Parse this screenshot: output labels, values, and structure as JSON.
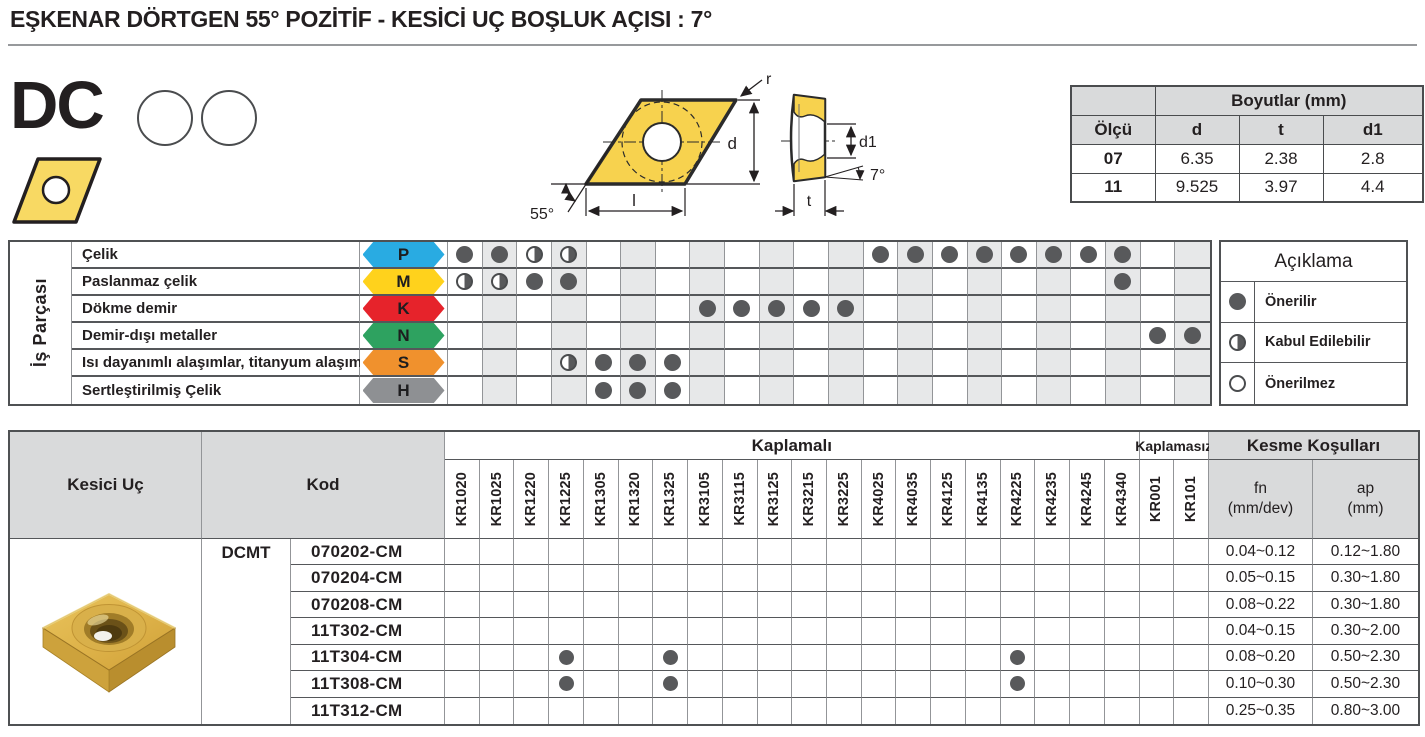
{
  "page": {
    "title": "EŞKENAR DÖRTGEN 55° POZİTİF - KESİCİ UÇ BOŞLUK AÇISI : 7°"
  },
  "product": {
    "family": "DC"
  },
  "drawing": {
    "r": "r",
    "d": "d",
    "l": "l",
    "corner_angle": "55°",
    "d1": "d1",
    "clearance_angle": "7°",
    "t": "t"
  },
  "dimensions_table": {
    "title": "Boyutlar (mm)",
    "columns": [
      "Ölçü",
      "d",
      "t",
      "d1"
    ],
    "rows": [
      {
        "olcu": "07",
        "d": "6.35",
        "t": "2.38",
        "d1": "2.8"
      },
      {
        "olcu": "11",
        "d": "9.525",
        "t": "3.97",
        "d1": "4.4"
      }
    ]
  },
  "grades": [
    "KR1020",
    "KR1025",
    "KR1220",
    "KR1225",
    "KR1305",
    "KR1320",
    "KR1325",
    "KR3105",
    "KR3115",
    "KR3125",
    "KR3215",
    "KR3225",
    "KR4025",
    "KR4035",
    "KR4125",
    "KR4135",
    "KR4225",
    "KR4235",
    "KR4245",
    "KR4340",
    "KR001",
    "KR101"
  ],
  "material_matrix": {
    "side_label": "İş Parçası",
    "rows": [
      {
        "label": "Çelik",
        "letter": "P",
        "color": "#29ABE2",
        "dots": [
          "F",
          "F",
          "H",
          "H",
          "",
          "",
          "",
          "",
          "",
          "",
          "",
          "",
          "F",
          "F",
          "F",
          "F",
          "F",
          "F",
          "F",
          "F",
          "",
          ""
        ]
      },
      {
        "label": "Paslanmaz çelik",
        "letter": "M",
        "color": "#FFD21C",
        "dots": [
          "H",
          "H",
          "F",
          "F",
          "",
          "",
          "",
          "",
          "",
          "",
          "",
          "",
          "",
          "",
          "",
          "",
          "",
          "",
          "",
          "F",
          "",
          ""
        ]
      },
      {
        "label": "Dökme demir",
        "letter": "K",
        "color": "#E6232B",
        "dots": [
          "",
          "",
          "",
          "",
          "",
          "",
          "",
          "F",
          "F",
          "F",
          "F",
          "F",
          "",
          "",
          "",
          "",
          "",
          "",
          "",
          "",
          "",
          ""
        ]
      },
      {
        "label": "Demir-dışı metaller",
        "letter": "N",
        "color": "#2EA260",
        "dots": [
          "",
          "",
          "",
          "",
          "",
          "",
          "",
          "",
          "",
          "",
          "",
          "",
          "",
          "",
          "",
          "",
          "",
          "",
          "",
          "",
          "F",
          "F"
        ]
      },
      {
        "label": "Isı dayanımlı alaşımlar, titanyum alaşımları",
        "letter": "S",
        "color": "#F0912D",
        "dots": [
          "",
          "",
          "",
          "H",
          "F",
          "F",
          "F",
          "",
          "",
          "",
          "",
          "",
          "",
          "",
          "",
          "",
          "",
          "",
          "",
          "",
          "",
          ""
        ]
      },
      {
        "label": "Sertleştirilmiş Çelik",
        "letter": "H",
        "color": "#8E9093",
        "dots": [
          "",
          "",
          "",
          "",
          "F",
          "F",
          "F",
          "",
          "",
          "",
          "",
          "",
          "",
          "",
          "",
          "",
          "",
          "",
          "",
          "",
          "",
          ""
        ]
      }
    ]
  },
  "legend": {
    "title": "Açıklama",
    "items": [
      {
        "symbol": "F",
        "label": "Önerilir"
      },
      {
        "symbol": "H",
        "label": "Kabul Edilebilir"
      },
      {
        "symbol": "E",
        "label": "Önerilmez"
      }
    ]
  },
  "insert_table": {
    "col_insert": "Kesici Uç",
    "col_code": "Kod",
    "coated_label": "Kaplamalı",
    "uncoated_label": "Kaplamasız",
    "cutting_label": "Kesme Koşulları",
    "fn_label": "fn",
    "fn_unit": "(mm/dev)",
    "ap_label": "ap",
    "ap_unit": "(mm)",
    "series": "DCMT",
    "rows": [
      {
        "code": "070202-CM",
        "dots": [],
        "fn": "0.04~0.12",
        "ap": "0.12~1.80"
      },
      {
        "code": "070204-CM",
        "dots": [],
        "fn": "0.05~0.15",
        "ap": "0.30~1.80"
      },
      {
        "code": "070208-CM",
        "dots": [],
        "fn": "0.08~0.22",
        "ap": "0.30~1.80"
      },
      {
        "code": "11T302-CM",
        "dots": [],
        "fn": "0.04~0.15",
        "ap": "0.30~2.00"
      },
      {
        "code": "11T304-CM",
        "dots": [
          "KR1225",
          "KR1325",
          "KR4225"
        ],
        "fn": "0.08~0.20",
        "ap": "0.50~2.30"
      },
      {
        "code": "11T308-CM",
        "dots": [
          "KR1225",
          "KR1325",
          "KR4225"
        ],
        "fn": "0.10~0.30",
        "ap": "0.50~2.30"
      },
      {
        "code": "11T312-CM",
        "dots": [],
        "fn": "0.25~0.35",
        "ap": "0.80~3.00"
      }
    ]
  }
}
